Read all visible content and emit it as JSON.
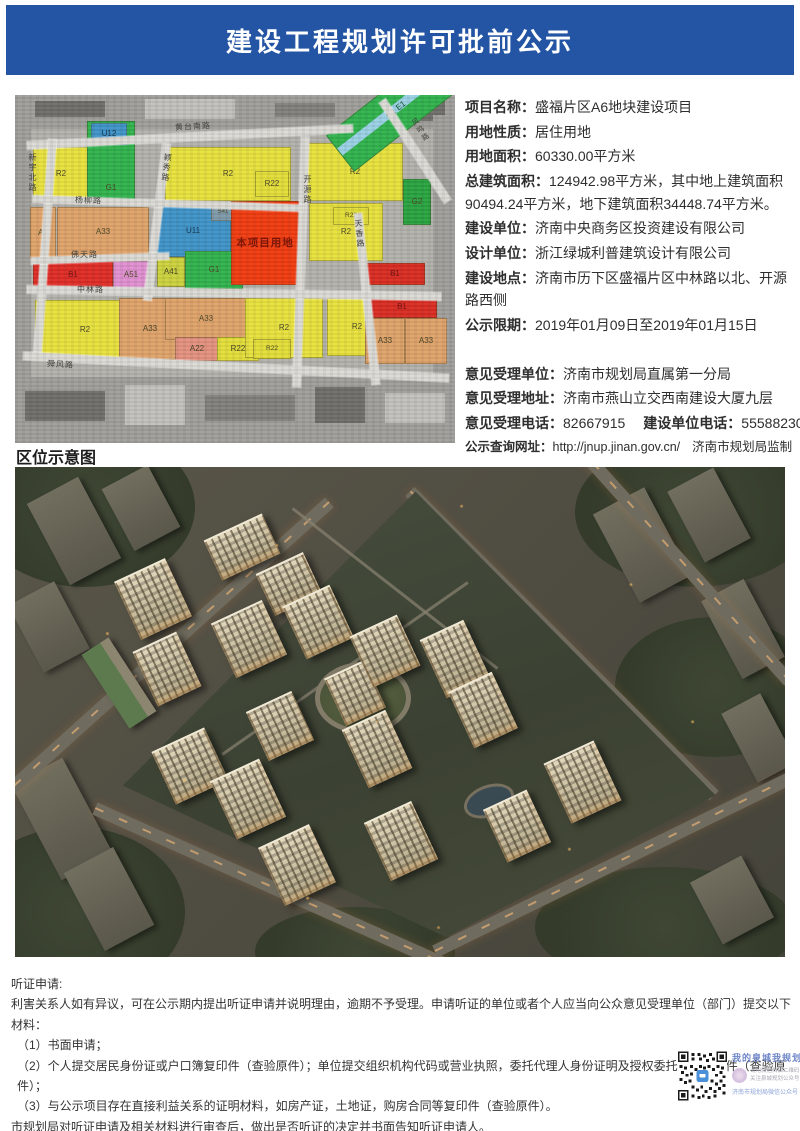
{
  "header": {
    "title": "建设工程规划许可批前公示"
  },
  "colors": {
    "header_blue": "#2455a4",
    "project_red": "#f13a0e",
    "residential_yellow": "#e8e23c",
    "green_space": "#2fb24c",
    "public_blue": "#3e93c8",
    "amenity_orange": "#dfa269"
  },
  "map": {
    "caption": "区位示意图",
    "roads": [
      "黄台南路",
      "新宇北路",
      "颖秀路",
      "开源路",
      "天香路",
      "凤鸣路",
      "杨柳路",
      "佛天路",
      "中林路",
      "舜风路"
    ],
    "parcels": [
      "R2",
      "G1",
      "U12",
      "R2",
      "R22",
      "R2",
      "G1 E1",
      "G2",
      "A2",
      "A33",
      "U11",
      "S41",
      "A41",
      "G1",
      "本项目用地",
      "R2",
      "R22",
      "B1",
      "B1",
      "A51",
      "R2",
      "A33",
      "A33",
      "A22",
      "R22",
      "R2",
      "R22",
      "R2",
      "B1",
      "A33",
      "A33"
    ]
  },
  "info": {
    "rows": [
      {
        "label": "项目名称：",
        "value": "盛福片区A6地块建设项目"
      },
      {
        "label": "用地性质：",
        "value": "居住用地"
      },
      {
        "label": "用地面积：",
        "value": "60330.00平方米"
      },
      {
        "label": "总建筑面积：",
        "value": "124942.98平方米，其中地上建筑面积90494.24平方米，地下建筑面积34448.74平方米。"
      },
      {
        "label": "建设单位：",
        "value": "济南中央商务区投资建设有限公司"
      },
      {
        "label": "设计单位：",
        "value": "浙江绿城利普建筑设计有限公司"
      },
      {
        "label": "建设地点：",
        "value": "济南市历下区盛福片区中林路以北、开源路西侧"
      },
      {
        "label": "公示限期：",
        "value": "2019年01月09日至2019年01月15日"
      }
    ],
    "contact_rows": [
      {
        "label": "意见受理单位：",
        "value": "济南市规划局直属第一分局"
      },
      {
        "label": "意见受理地址：",
        "value": "济南市燕山立交西南建设大厦九层"
      },
      {
        "label": "意见受理电话：",
        "value": "82667915",
        "label2": "建设单位电话：",
        "value2": "55588230"
      },
      {
        "label": "公示查询网址：",
        "value": "http://jnup.jinan.gov.cn/",
        "suffix": "济南市规划局监制"
      }
    ]
  },
  "notice": {
    "title": "听证申请:",
    "paragraphs": [
      "利害关系人如有异议，可在公示期内提出听证申请并说明理由，逾期不予受理。申请听证的单位或者个人应当向公众意见受理单位（部门）提交以下材料：",
      "（1）书面申请；",
      "（2）个人提交居民身份证或户口簿复印件（查验原件）；单位提交组织机构代码或营业执照，委托代理人身份证明及授权委托书的复印件（查验原件）；",
      "（3）与公示项目存在直接利益关系的证明材料，如房产证，土地证，购房合同等复印件（查验原件）。",
      "市规划局对听证申请及相关材料进行审查后，做出是否听证的决定并书面告知听证申请人。"
    ]
  },
  "qr": {
    "slogan": "我的泉城我规划",
    "tip_line1": "请用微信扫描二维码",
    "tip_line2": "关注泉城规划公众号",
    "account": "济南市规划局微信公众号"
  }
}
